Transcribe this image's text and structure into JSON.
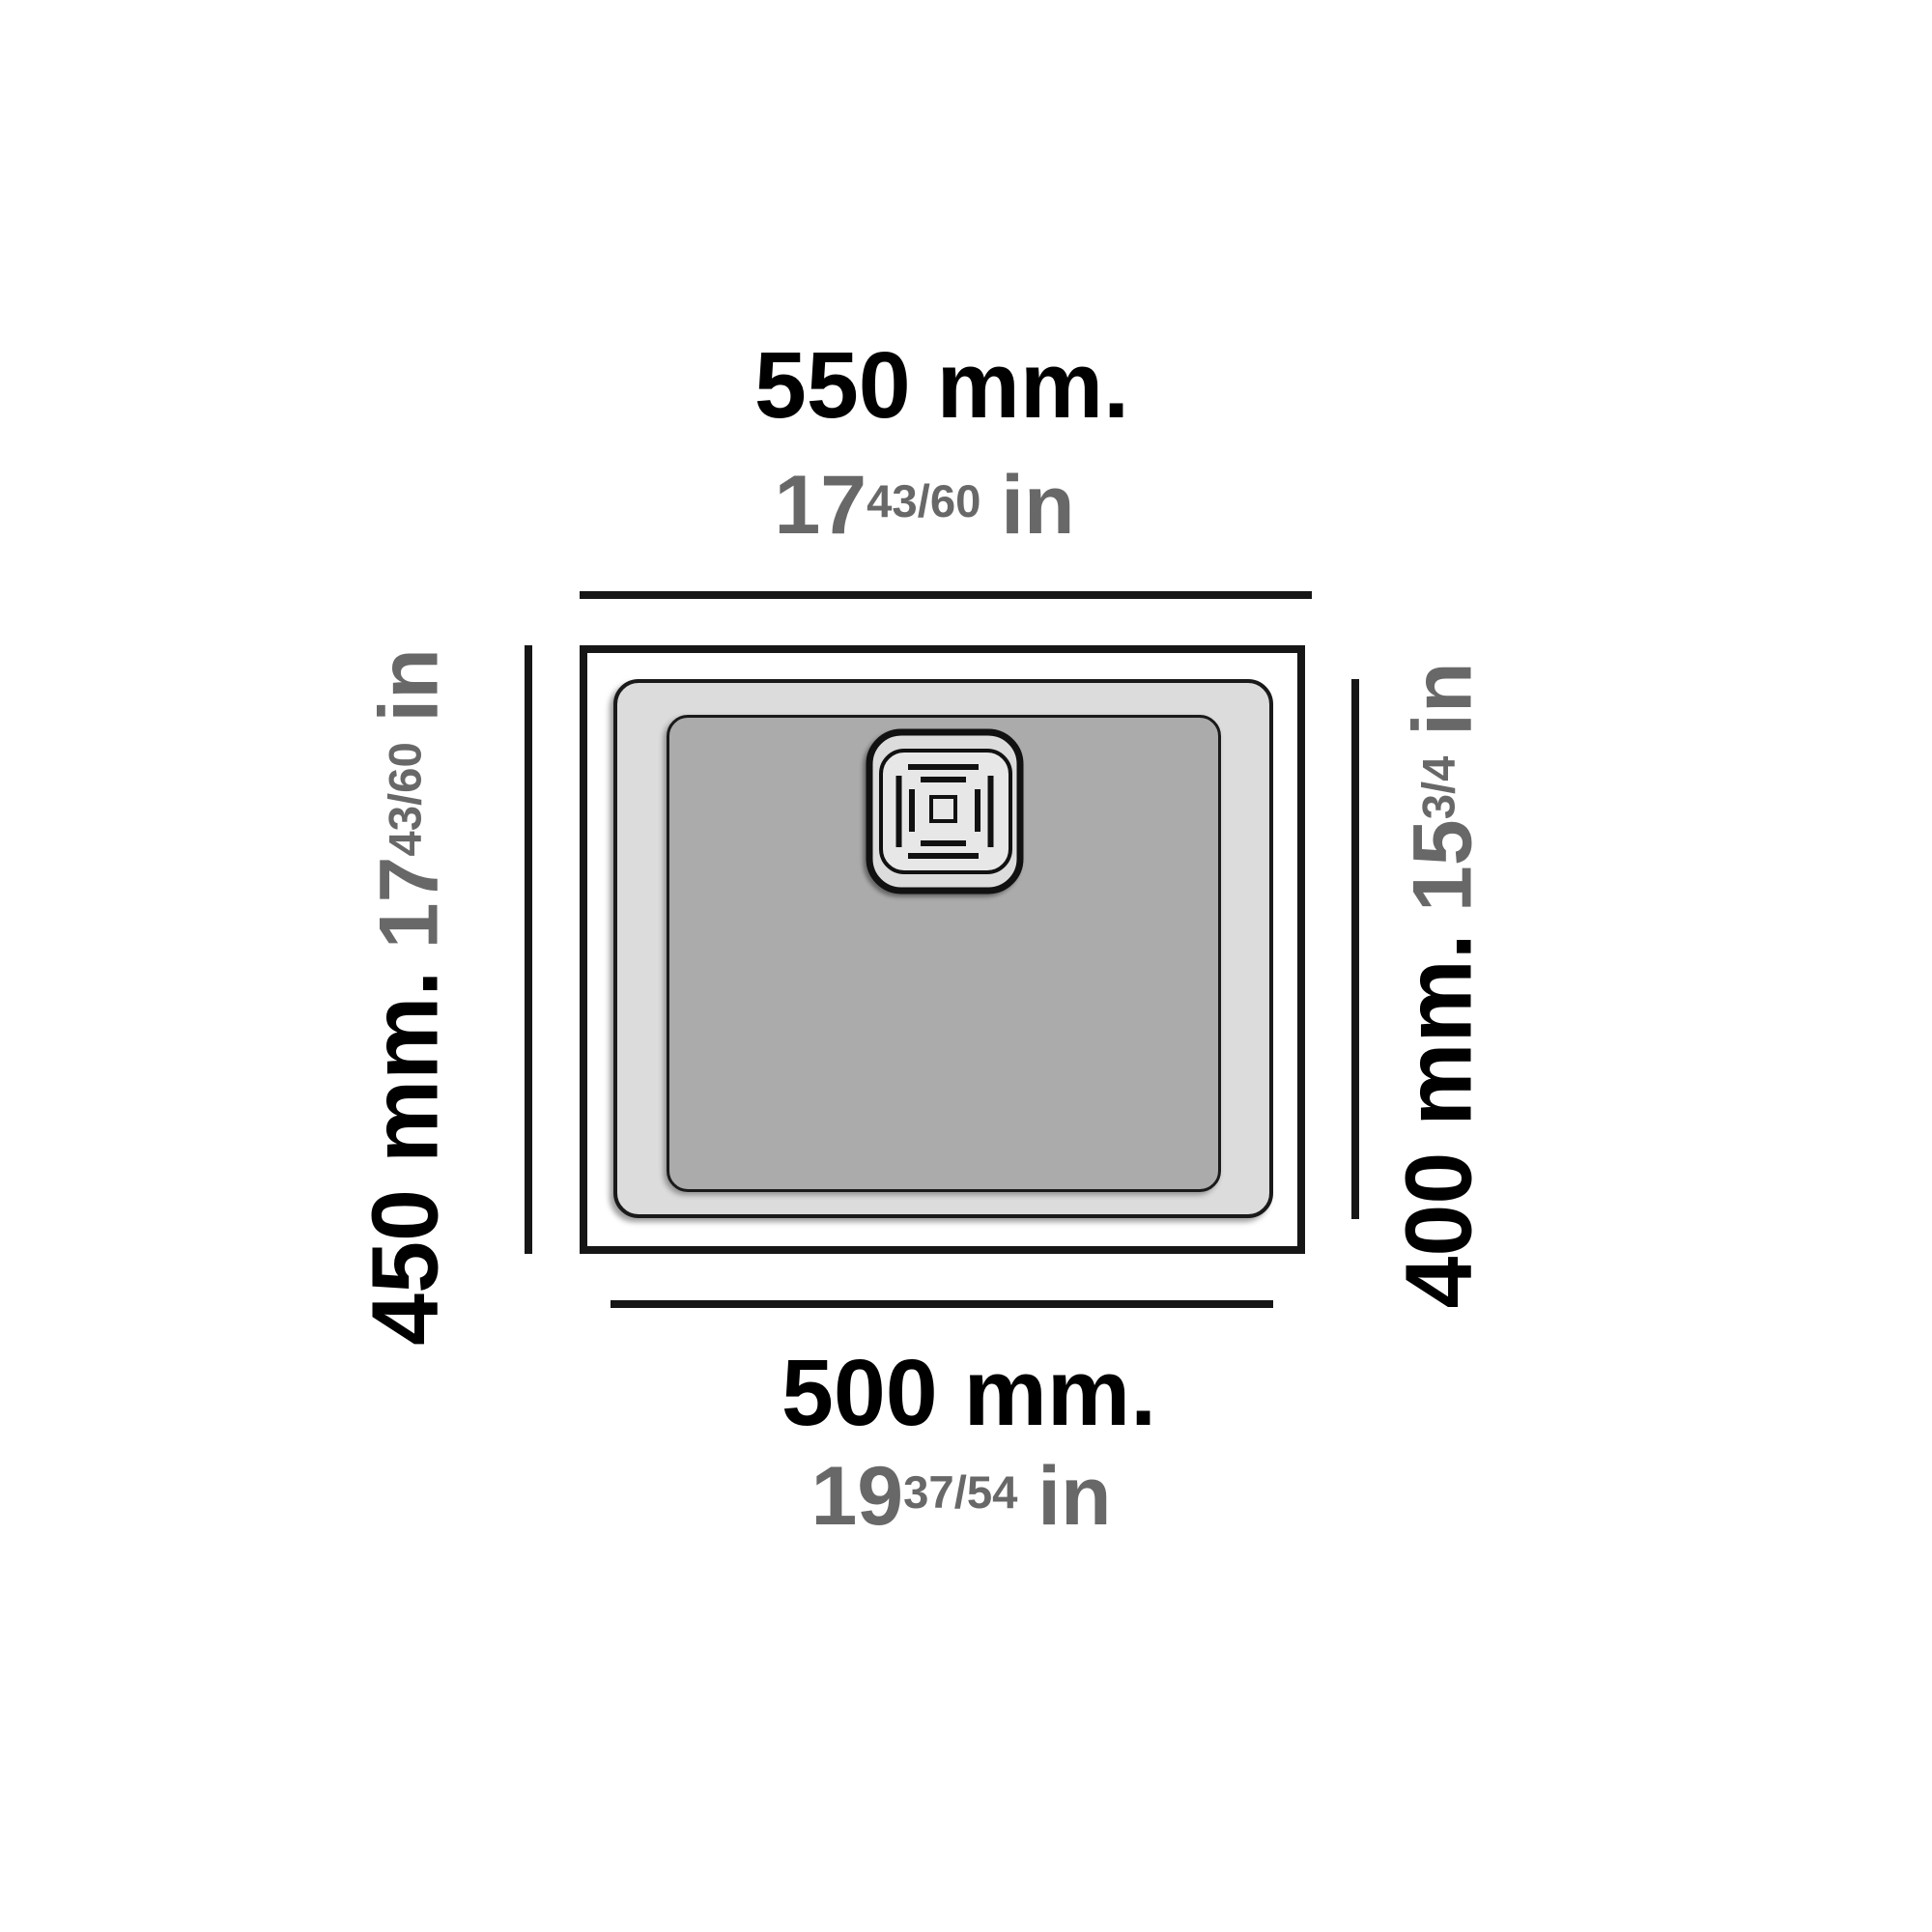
{
  "diagram": {
    "title": "Sink top-view dimension drawing",
    "dimensions": {
      "top": {
        "mm": "550 mm.",
        "inch_whole": "17",
        "inch_fraction": "43/60",
        "inch_unit": "in"
      },
      "bottom": {
        "mm": "500 mm.",
        "inch_whole": "19",
        "inch_fraction": "37/54",
        "inch_unit": "in"
      },
      "left": {
        "mm": "450 mm.",
        "inch_whole": "17",
        "inch_fraction": "43/60",
        "inch_unit": "in"
      },
      "right": {
        "mm": "400 mm.",
        "inch_whole": "15",
        "inch_fraction": "3/4",
        "inch_unit": "in"
      }
    },
    "colors": {
      "mm_text": "#000000",
      "inch_text": "#686868",
      "line": "#161616",
      "rim_fill": "#ffffff",
      "bowl_rim_fill": "#dcdcdc",
      "bowl_fill": "#ababab",
      "drain_fill": "#dcdcdc"
    }
  }
}
